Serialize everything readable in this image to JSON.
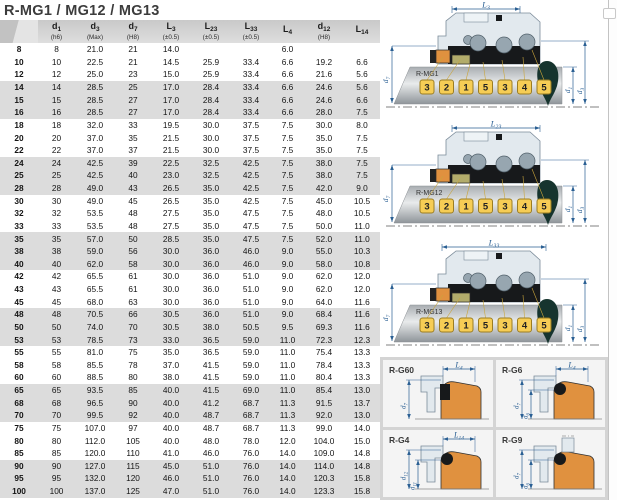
{
  "page": {
    "title": "R-MG1 / MG12 / MG13"
  },
  "table": {
    "columns": [
      {
        "id": "size",
        "base": "",
        "sub": "",
        "tol": ""
      },
      {
        "id": "d1",
        "base": "d",
        "sub": "1",
        "tol": "(h6)"
      },
      {
        "id": "d3",
        "base": "d",
        "sub": "3",
        "tol": "(Max)"
      },
      {
        "id": "d7",
        "base": "d",
        "sub": "7",
        "tol": "(H8)"
      },
      {
        "id": "L3",
        "base": "L",
        "sub": "3",
        "tol": "(±0.5)"
      },
      {
        "id": "L23",
        "base": "L",
        "sub": "23",
        "tol": "(±0.5)"
      },
      {
        "id": "L33",
        "base": "L",
        "sub": "33",
        "tol": "(±0.5)"
      },
      {
        "id": "L4",
        "base": "L",
        "sub": "4",
        "tol": ""
      },
      {
        "id": "d12",
        "base": "d",
        "sub": "12",
        "tol": "(H8)"
      },
      {
        "id": "L14",
        "base": "L",
        "sub": "14",
        "tol": ""
      }
    ],
    "rows": [
      [
        "8",
        "8",
        "21.0",
        "21",
        "14.0",
        "",
        "",
        "6.0",
        "",
        ""
      ],
      [
        "10",
        "10",
        "22.5",
        "21",
        "14.5",
        "25.9",
        "33.4",
        "6.6",
        "19.2",
        "6.6"
      ],
      [
        "12",
        "12",
        "25.0",
        "23",
        "15.0",
        "25.9",
        "33.4",
        "6.6",
        "21.6",
        "5.6"
      ],
      [
        "14",
        "14",
        "28.5",
        "25",
        "17.0",
        "28.4",
        "33.4",
        "6.6",
        "24.6",
        "5.6"
      ],
      [
        "15",
        "15",
        "28.5",
        "27",
        "17.0",
        "28.4",
        "33.4",
        "6.6",
        "24.6",
        "6.6"
      ],
      [
        "16",
        "16",
        "28.5",
        "27",
        "17.0",
        "28.4",
        "33.4",
        "6.6",
        "28.0",
        "7.5"
      ],
      [
        "18",
        "18",
        "32.0",
        "33",
        "19.5",
        "30.0",
        "37.5",
        "7.5",
        "30.0",
        "8.0"
      ],
      [
        "20",
        "20",
        "37.0",
        "35",
        "21.5",
        "30.0",
        "37.5",
        "7.5",
        "35.0",
        "7.5"
      ],
      [
        "22",
        "22",
        "37.0",
        "37",
        "21.5",
        "30.0",
        "37.5",
        "7.5",
        "35.0",
        "7.5"
      ],
      [
        "24",
        "24",
        "42.5",
        "39",
        "22.5",
        "32.5",
        "42.5",
        "7.5",
        "38.0",
        "7.5"
      ],
      [
        "25",
        "25",
        "42.5",
        "40",
        "23.0",
        "32.5",
        "42.5",
        "7.5",
        "38.0",
        "7.5"
      ],
      [
        "28",
        "28",
        "49.0",
        "43",
        "26.5",
        "35.0",
        "42.5",
        "7.5",
        "42.0",
        "9.0"
      ],
      [
        "30",
        "30",
        "49.0",
        "45",
        "26.5",
        "35.0",
        "42.5",
        "7.5",
        "45.0",
        "10.5"
      ],
      [
        "32",
        "32",
        "53.5",
        "48",
        "27.5",
        "35.0",
        "47.5",
        "7.5",
        "48.0",
        "10.5"
      ],
      [
        "33",
        "33",
        "53.5",
        "48",
        "27.5",
        "35.0",
        "47.5",
        "7.5",
        "50.0",
        "11.0"
      ],
      [
        "35",
        "35",
        "57.0",
        "50",
        "28.5",
        "35.0",
        "47.5",
        "7.5",
        "52.0",
        "11.0"
      ],
      [
        "38",
        "38",
        "59.0",
        "56",
        "30.0",
        "36.0",
        "46.0",
        "9.0",
        "55.0",
        "10.3"
      ],
      [
        "40",
        "40",
        "62.0",
        "58",
        "30.0",
        "36.0",
        "46.0",
        "9.0",
        "58.0",
        "10.8"
      ],
      [
        "42",
        "42",
        "65.5",
        "61",
        "30.0",
        "36.0",
        "51.0",
        "9.0",
        "62.0",
        "12.0"
      ],
      [
        "43",
        "43",
        "65.5",
        "61",
        "30.0",
        "36.0",
        "51.0",
        "9.0",
        "62.0",
        "12.0"
      ],
      [
        "45",
        "45",
        "68.0",
        "63",
        "30.0",
        "36.0",
        "51.0",
        "9.0",
        "64.0",
        "11.6"
      ],
      [
        "48",
        "48",
        "70.5",
        "66",
        "30.5",
        "36.0",
        "51.0",
        "9.0",
        "68.4",
        "11.6"
      ],
      [
        "50",
        "50",
        "74.0",
        "70",
        "30.5",
        "38.0",
        "50.5",
        "9.5",
        "69.3",
        "11.6"
      ],
      [
        "53",
        "53",
        "78.5",
        "73",
        "33.0",
        "36.5",
        "59.0",
        "11.0",
        "72.3",
        "12.3"
      ],
      [
        "55",
        "55",
        "81.0",
        "75",
        "35.0",
        "36.5",
        "59.0",
        "11.0",
        "75.4",
        "13.3"
      ],
      [
        "58",
        "58",
        "85.5",
        "78",
        "37.0",
        "41.5",
        "59.0",
        "11.0",
        "78.4",
        "13.3"
      ],
      [
        "60",
        "60",
        "88.5",
        "80",
        "38.0",
        "41.5",
        "59.0",
        "11.0",
        "80.4",
        "13.3"
      ],
      [
        "65",
        "65",
        "93.5",
        "85",
        "40.0",
        "41.5",
        "69.0",
        "11.0",
        "85.4",
        "13.0"
      ],
      [
        "68",
        "68",
        "96.5",
        "90",
        "40.0",
        "41.2",
        "68.7",
        "11.3",
        "91.5",
        "13.7"
      ],
      [
        "70",
        "70",
        "99.5",
        "92",
        "40.0",
        "48.7",
        "68.7",
        "11.3",
        "92.0",
        "13.0"
      ],
      [
        "75",
        "75",
        "107.0",
        "97",
        "40.0",
        "48.7",
        "68.7",
        "11.3",
        "99.0",
        "14.0"
      ],
      [
        "80",
        "80",
        "112.0",
        "105",
        "40.0",
        "48.0",
        "78.0",
        "12.0",
        "104.0",
        "15.0"
      ],
      [
        "85",
        "85",
        "120.0",
        "110",
        "41.0",
        "46.0",
        "76.0",
        "14.0",
        "109.0",
        "14.8"
      ],
      [
        "90",
        "90",
        "127.0",
        "115",
        "45.0",
        "51.0",
        "76.0",
        "14.0",
        "114.0",
        "14.8"
      ],
      [
        "95",
        "95",
        "132.0",
        "120",
        "46.0",
        "51.0",
        "76.0",
        "14.0",
        "120.3",
        "15.8"
      ],
      [
        "100",
        "100",
        "137.0",
        "125",
        "47.0",
        "51.0",
        "76.0",
        "14.0",
        "123.3",
        "15.8"
      ]
    ]
  },
  "diagrams": [
    {
      "name": "R-MG1",
      "length_dim": {
        "base": "L",
        "sub": "3"
      },
      "left_dim": {
        "base": "d",
        "sub": "7"
      },
      "right_dims": [
        {
          "base": "d",
          "sub": "1"
        },
        {
          "base": "d",
          "sub": "3"
        }
      ],
      "callouts": [
        "3",
        "2",
        "1",
        "5",
        "3",
        "4",
        "5"
      ]
    },
    {
      "name": "R-MG12",
      "length_dim": {
        "base": "L",
        "sub": "23"
      },
      "left_dim": {
        "base": "d",
        "sub": "7"
      },
      "right_dims": [
        {
          "base": "d",
          "sub": "1"
        },
        {
          "base": "d",
          "sub": "3"
        }
      ],
      "callouts": [
        "3",
        "2",
        "1",
        "5",
        "3",
        "4",
        "5"
      ]
    },
    {
      "name": "R-MG13",
      "length_dim": {
        "base": "L",
        "sub": "33"
      },
      "left_dim": {
        "base": "d",
        "sub": "7"
      },
      "right_dims": [
        {
          "base": "d",
          "sub": "1"
        },
        {
          "base": "d",
          "sub": "3"
        }
      ],
      "callouts": [
        "3",
        "2",
        "1",
        "5",
        "3",
        "4",
        "5"
      ]
    }
  ],
  "seat_details": [
    {
      "name": "R-G60",
      "top_dim": {
        "base": "L",
        "sub": "4"
      },
      "side_dims": [
        {
          "base": "d",
          "sub": "7"
        }
      ],
      "oring": "rect"
    },
    {
      "name": "R-G6",
      "top_dim": {
        "base": "L",
        "sub": "4"
      },
      "side_dims": [
        {
          "base": "d",
          "sub": "7"
        },
        {
          "base": "d",
          "sub": "6"
        }
      ],
      "oring": "round"
    },
    {
      "name": "R-G4",
      "top_dim": {
        "base": "L",
        "sub": "14"
      },
      "side_dims": [
        {
          "base": "d",
          "sub": "12"
        },
        {
          "base": "d",
          "sub": "11"
        }
      ],
      "oring": "round"
    },
    {
      "name": "R-G9",
      "top_dim": null,
      "side_dims": [
        {
          "base": "d",
          "sub": "7"
        },
        {
          "base": "d",
          "sub": "6"
        }
      ],
      "oring": "round"
    }
  ],
  "colors": {
    "dimension_blue": "#2a5f93",
    "badge_yellow": "#f6cd55",
    "badge_border": "#9b7d22",
    "leader_gold": "#c9a53b",
    "seat_orange": "#e0913f",
    "packing_olive": "#b2ac6b",
    "spring_gray": "#97a6b0",
    "housing_fill": "#e2e9ee",
    "housing_stroke": "#7b8b99",
    "elastomer_black": "#17191b",
    "shaft_tip_teal": "#16342e",
    "header_gray": "#d0d0d0",
    "row_band_gray": "#dcdcdc"
  }
}
